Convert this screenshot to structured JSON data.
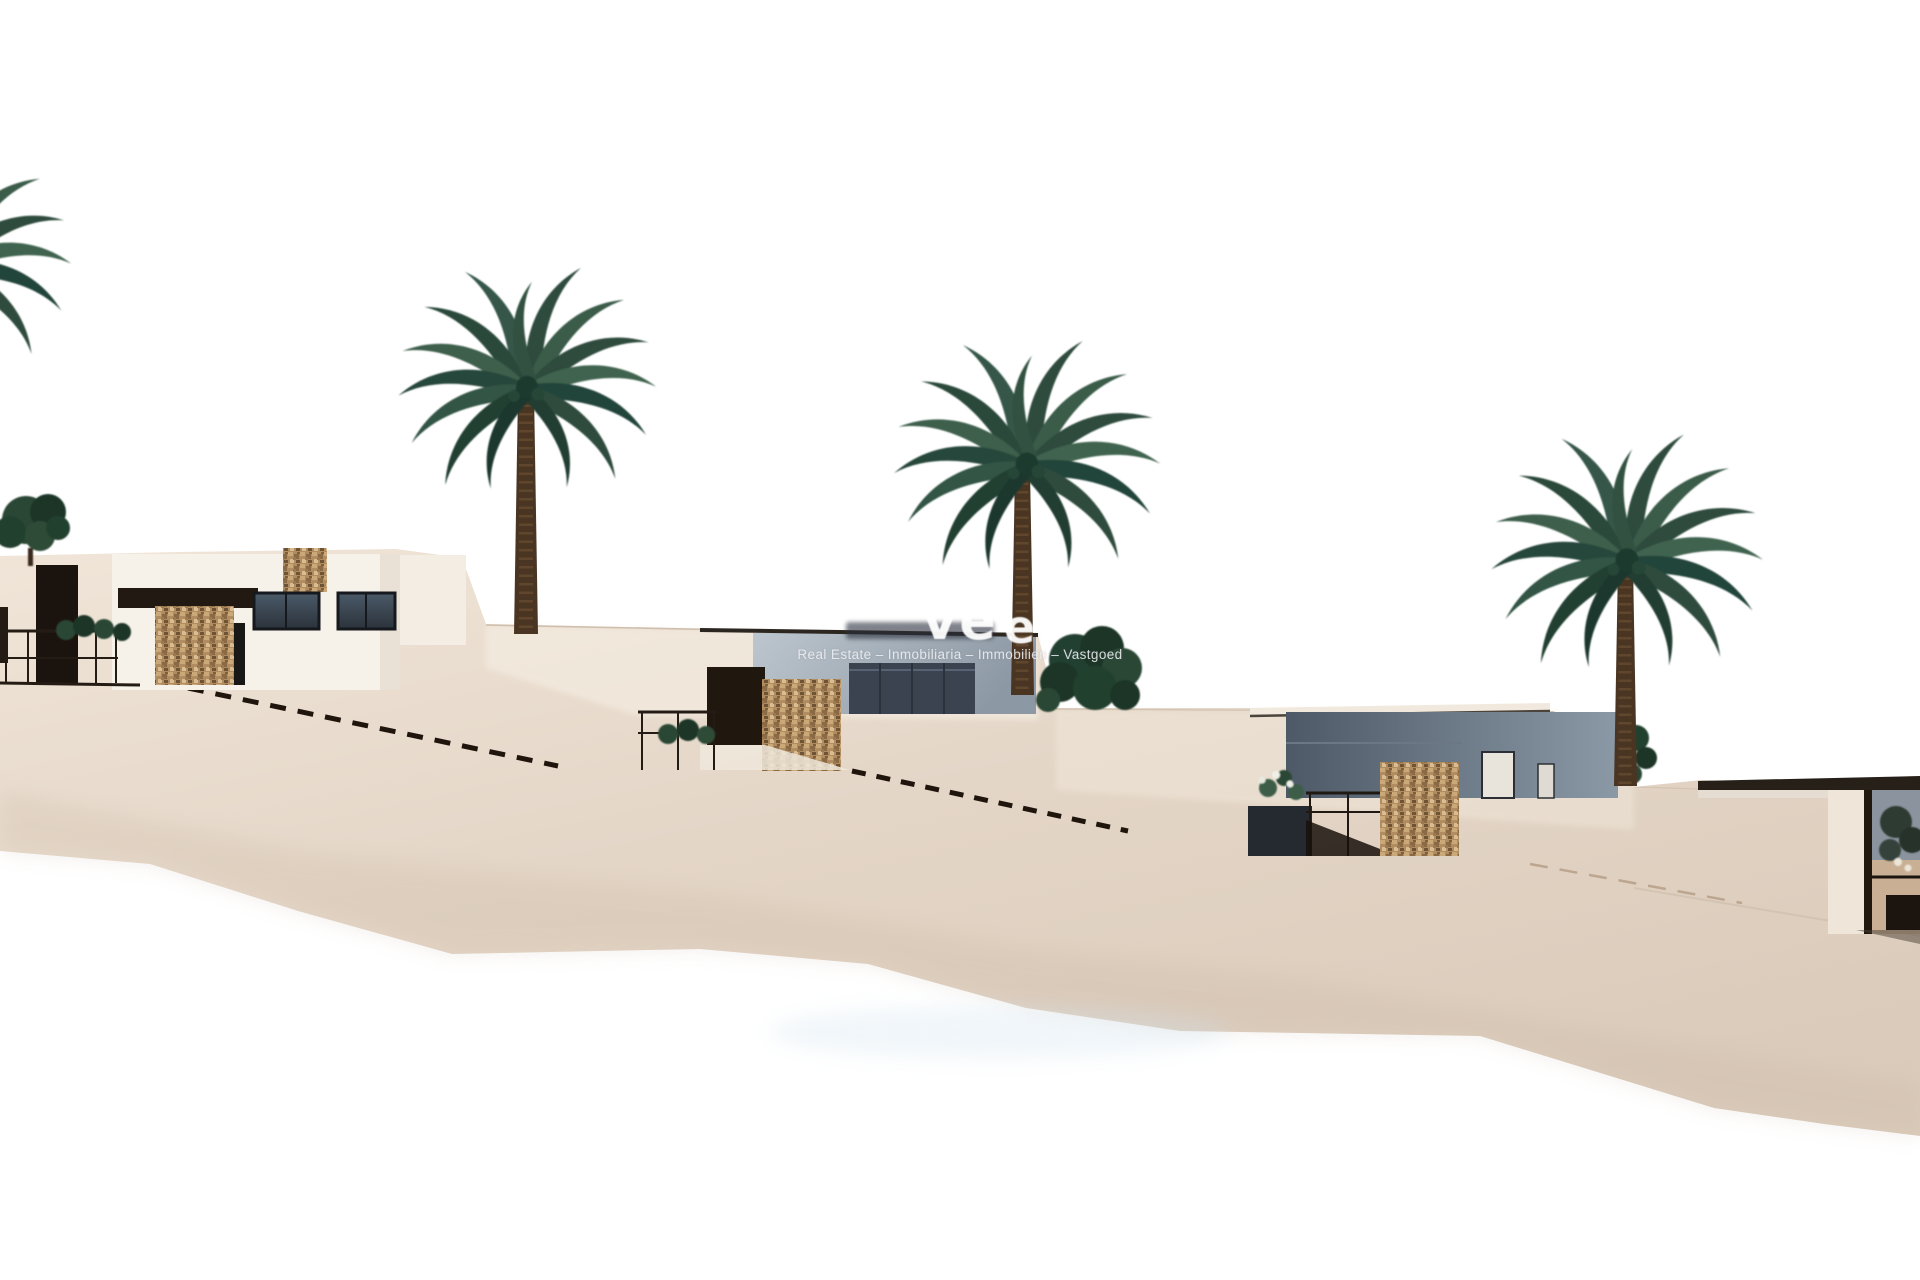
{
  "watermark": {
    "logo_fragment_1": "ve",
    "logo_fragment_2": "e",
    "tagline": "Real Estate – Inmobiliaria – Immobilien – Vastgoed"
  },
  "colors": {
    "sky": "#ffffff",
    "ground_light": "#f0e5d8",
    "ground_mid": "#e2d4c5",
    "ground_dark": "#d8c8b8",
    "palm_green": "#2d4c3c",
    "palm_trunk": "#4a3522",
    "stone_clad": "#b08c60",
    "dark_wood": "#20180f",
    "villa_white": "#f6f1e9",
    "facade_middle": "#9aa6b2",
    "facade_right": "#56636f",
    "glass_dark": "#39424d"
  }
}
